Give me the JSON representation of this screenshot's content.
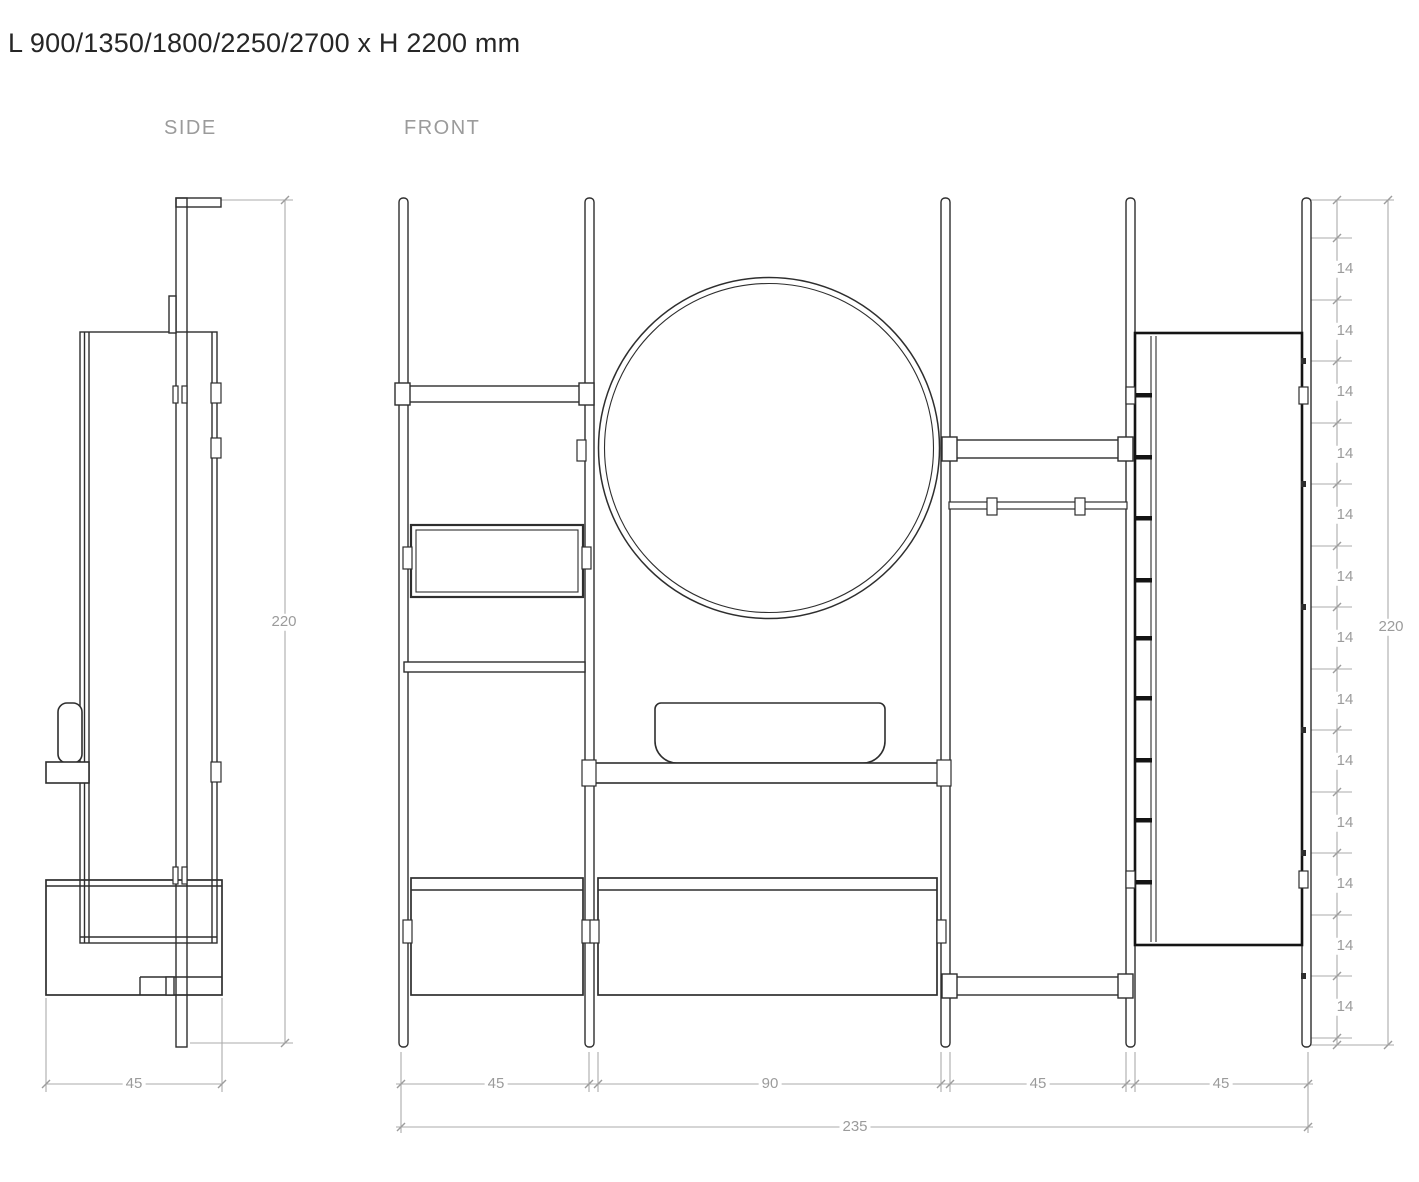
{
  "title": "L 900/1350/1800/2250/2700 x H 2200 mm",
  "views": {
    "side_label": "SIDE",
    "front_label": "FRONT"
  },
  "dimensions": {
    "side": {
      "depth": "45",
      "height": "220"
    },
    "front": {
      "sections": [
        "45",
        "90",
        "45",
        "45"
      ],
      "total_length": "235",
      "height": "220",
      "shelf_pitch": [
        "14",
        "14",
        "14",
        "14",
        "14",
        "14",
        "14",
        "14",
        "14",
        "14",
        "14",
        "14",
        "14"
      ]
    }
  },
  "drawing_styles": {
    "line_color": "#2e2e2e",
    "bold_line_color": "#141414",
    "dimension_line_color": "#ababab",
    "dimension_text_color": "#9b9b9b",
    "title_color": "#262626",
    "background": "#ffffff"
  }
}
